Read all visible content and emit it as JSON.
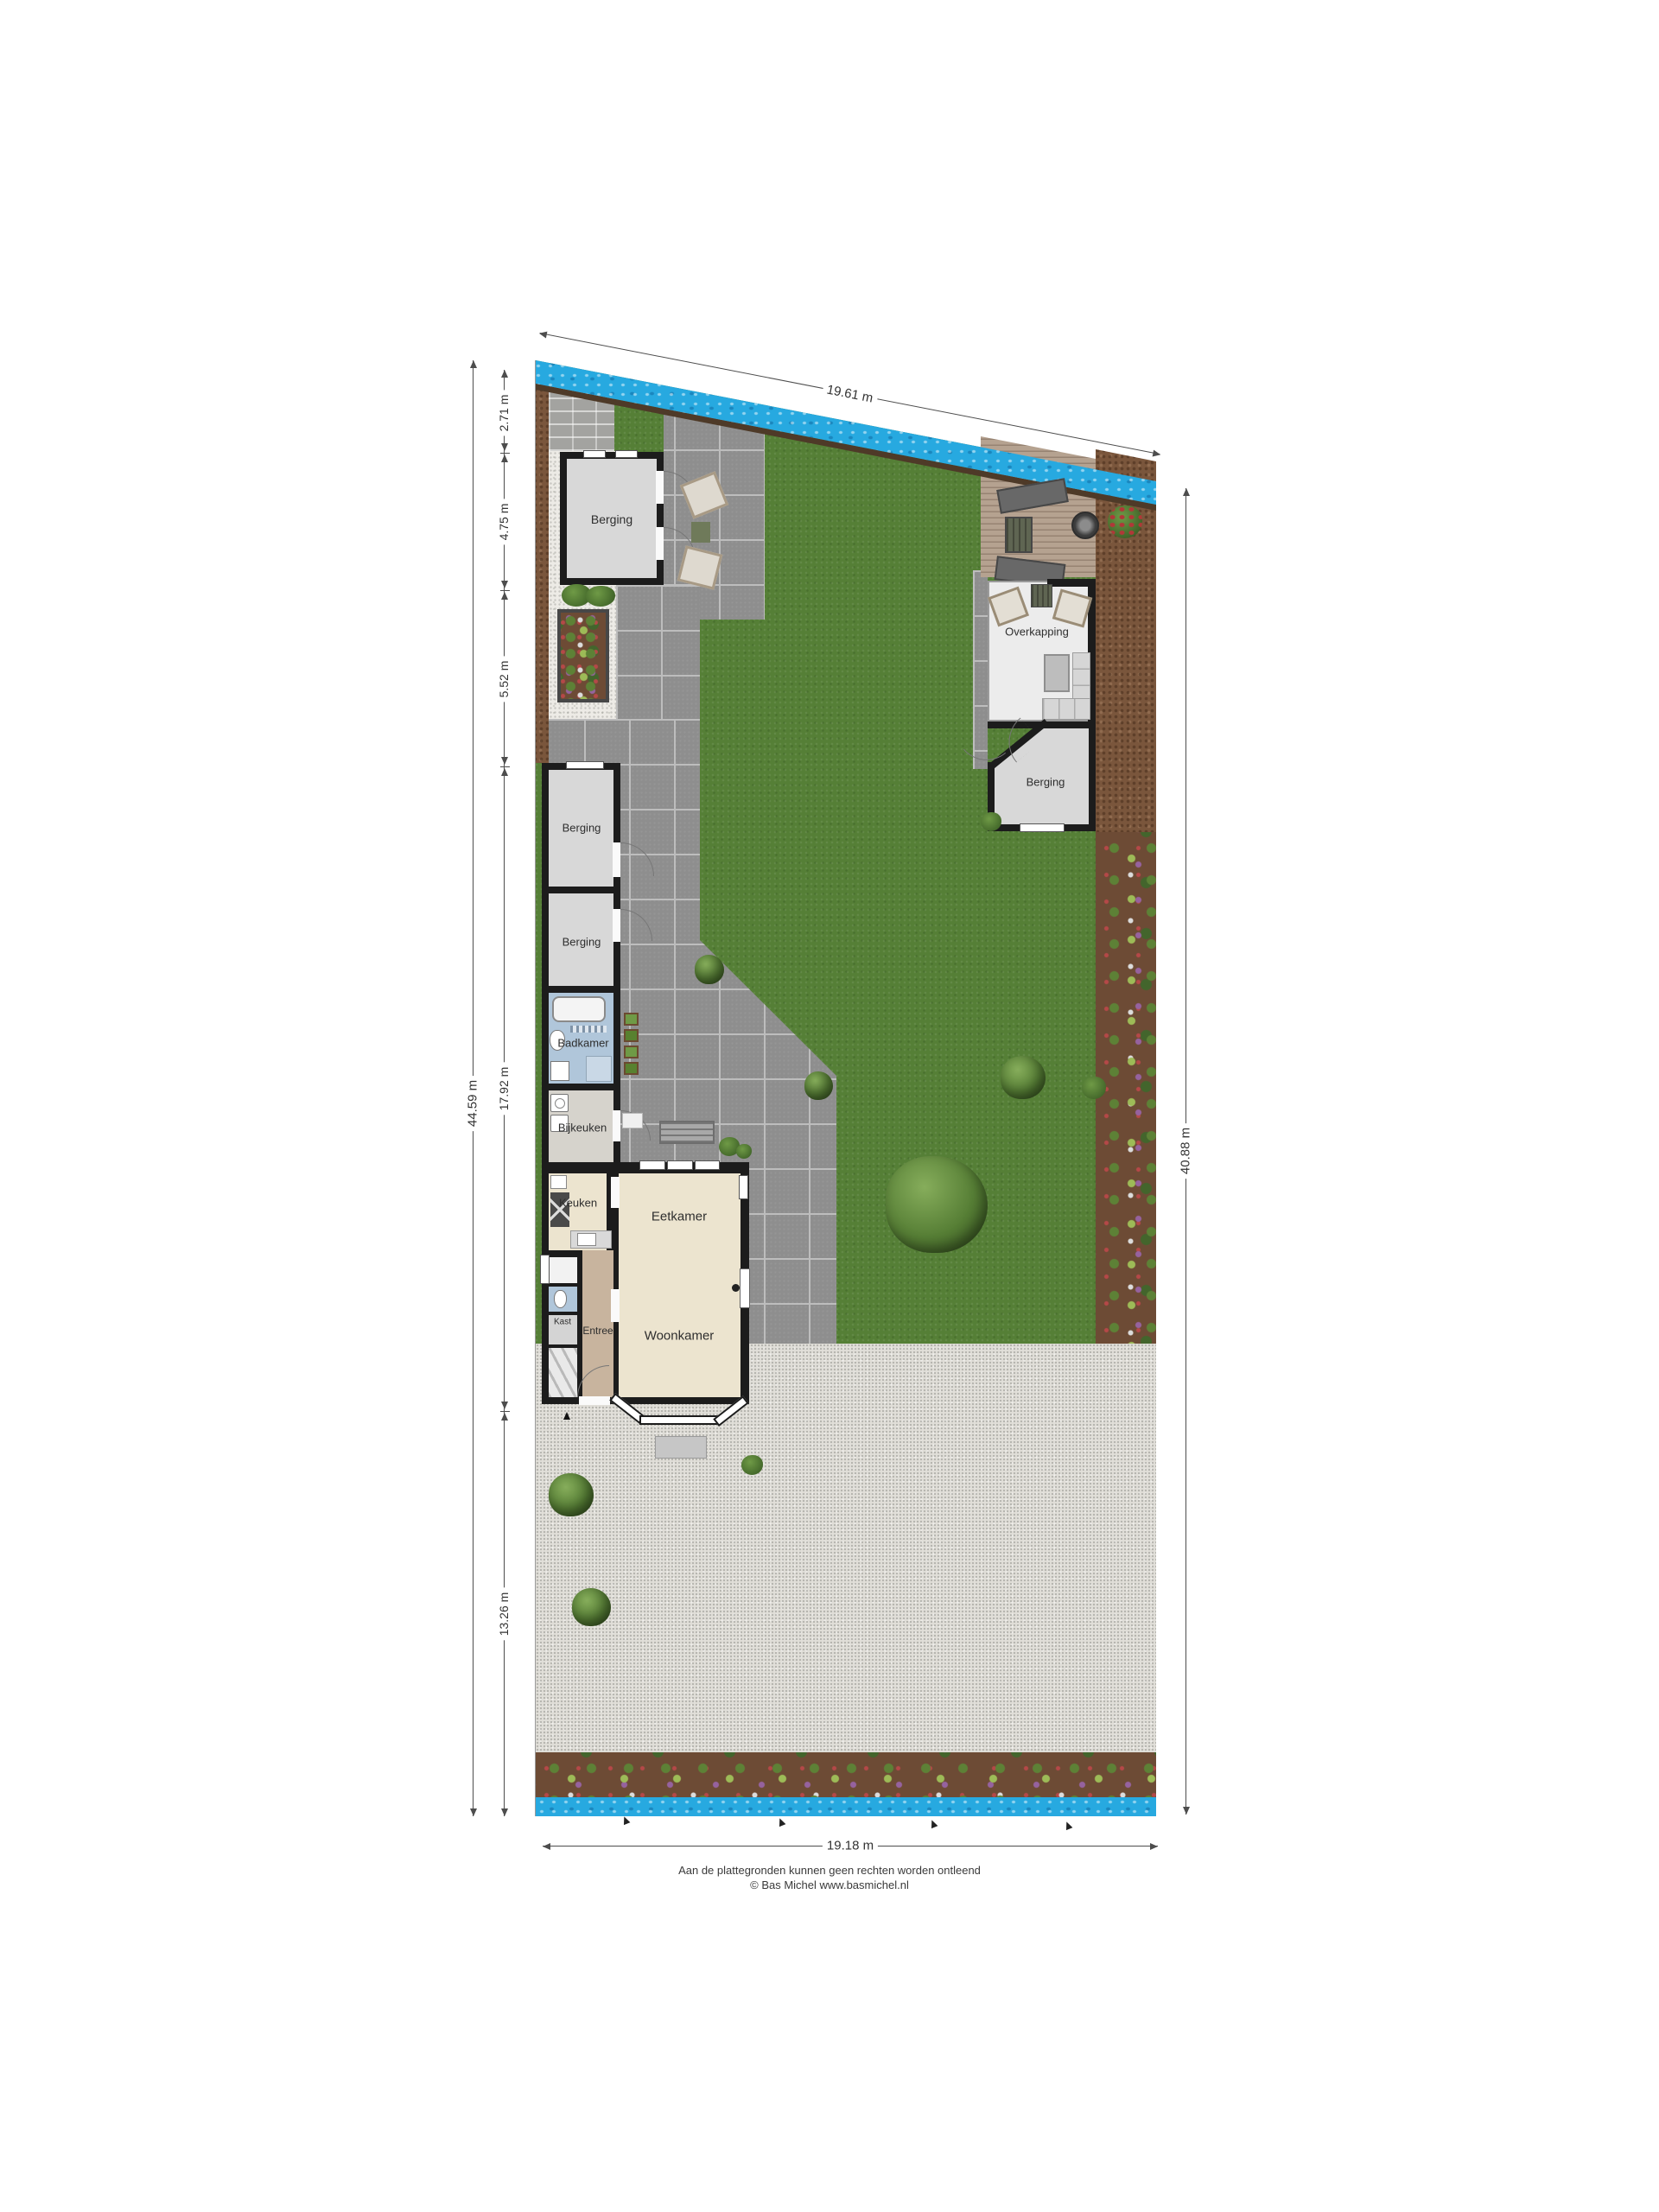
{
  "plan": {
    "title": "Garden site plan (plattegrond)",
    "labels": {
      "berging": "Berging",
      "overkapping": "Overkapping",
      "badkamer": "Badkamer",
      "bijkeuken": "Bijkeuken",
      "keuken": "Keuken",
      "eetkamer": "Eetkamer",
      "woonkamer": "Woonkamer",
      "entree": "Entree",
      "kast": "Kast"
    },
    "dimensions": {
      "top": "19.61 m",
      "right_total": "40.88 m",
      "left_total": "44.59 m",
      "left_segments": [
        "2.71 m",
        "4.75 m",
        "5.52 m",
        "17.92 m",
        "13.26 m"
      ],
      "bottom": "19.18 m"
    },
    "colors": {
      "lawn": "#557f36",
      "water": "#27a9e0",
      "tiles": "#8e8e8e",
      "soil": "#7a563c",
      "walls": "#1c1c1c",
      "floor_living": "#ece4cf",
      "floor_bath": "#b0c6da",
      "floor_hall": "#c8b49e"
    },
    "footer": {
      "disclaimer": "Aan de plattegronden kunnen geen rechten worden ontleend",
      "credit": "© Bas Michel www.basmichel.nl"
    }
  }
}
